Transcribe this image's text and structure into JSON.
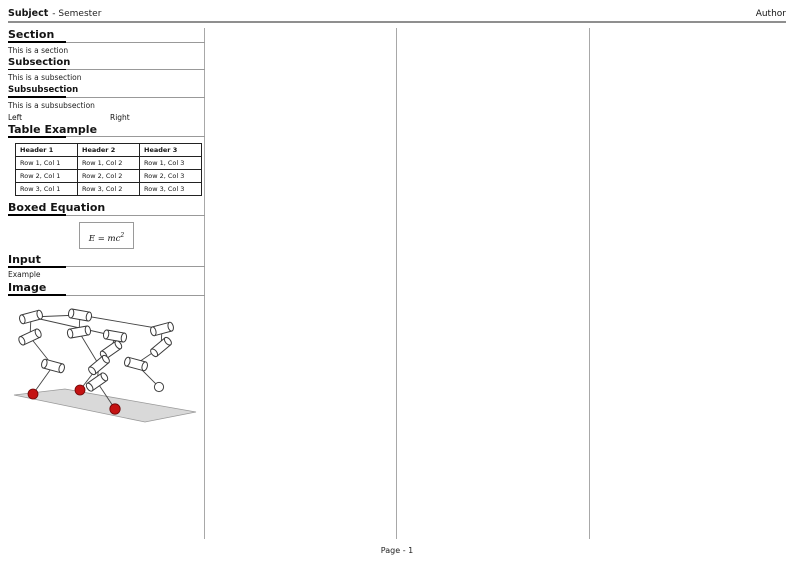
{
  "header": {
    "subject": "Subject",
    "rest": "- Semester",
    "author": "Author"
  },
  "sections": {
    "section": {
      "title": "Section",
      "body": "This is a section"
    },
    "subsection": {
      "title": "Subsection",
      "body": "This is a subsection"
    },
    "subsubsection": {
      "title": "Subsubsection",
      "body": "This is a subsubsection"
    },
    "two_col": {
      "left": "Left",
      "right": "Right"
    },
    "table": {
      "title": "Table Example",
      "headers": [
        "Header 1",
        "Header 2",
        "Header 3"
      ],
      "rows": [
        [
          "Row 1, Col 1",
          "Row 1, Col 2",
          "Row 1, Col 3"
        ],
        [
          "Row 2, Col 1",
          "Row 2, Col 2",
          "Row 2, Col 3"
        ],
        [
          "Row 3, Col 1",
          "Row 3, Col 2",
          "Row 3, Col 3"
        ]
      ]
    },
    "boxed_equation": {
      "title": "Boxed Equation",
      "equation_base": "E = mc",
      "equation_exponent": "2"
    },
    "input": {
      "title": "Input",
      "body": "Example"
    },
    "image": {
      "title": "Image"
    }
  },
  "figure": {
    "description": "robot-kinematics-figure",
    "foot_color": "#c41212",
    "free_foot_color": "#ffffff",
    "ground_color": "#d9d9d9",
    "outline_color": "#3a3a3a"
  },
  "footer": {
    "page": "Page - 1"
  },
  "colors": {
    "header_rule_gray": "#8f8f8f",
    "column_separator_gray": "#a8a8a8",
    "section_bar_black": "#000000"
  }
}
